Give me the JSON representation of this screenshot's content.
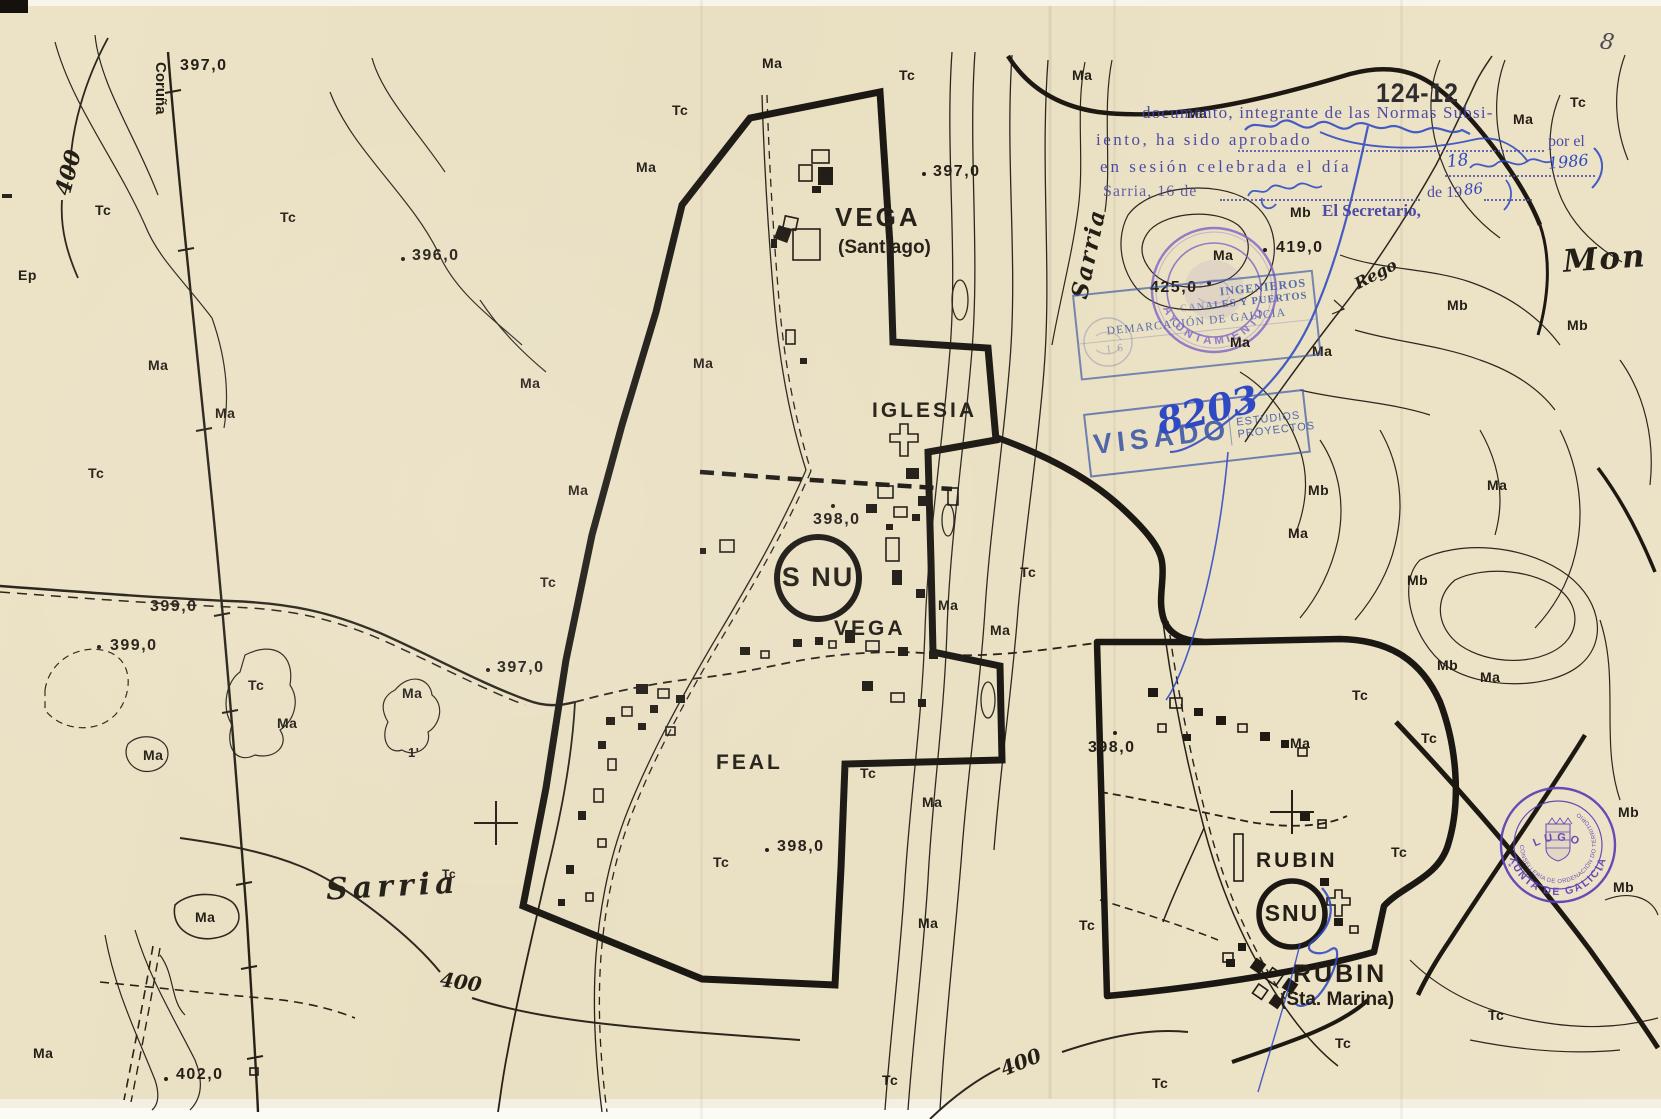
{
  "scan": {
    "page_number": "8",
    "sheet_code": "124-12"
  },
  "codes": {
    "ma": "Ma",
    "tc": "Tc",
    "mb": "Mb",
    "ep": "Ep",
    "tick": "1'"
  },
  "elevations": {
    "v396": "396,0",
    "v397": "397,0",
    "v398": "398,0",
    "v399": "399,0",
    "v400": "400",
    "v402": "402,0",
    "v419": "419,0",
    "v425": "425,0"
  },
  "places": {
    "coruna": "Coruña",
    "vega_main": "VEGA",
    "vega_main_sub": "(Santiago)",
    "iglesia": "IGLESIA",
    "vega_south": "VEGA",
    "feal": "FEAL",
    "snu_large": "S NU",
    "snu_small": "SNU",
    "sarria_town": "Sarria",
    "sarria_river": "Sarria",
    "rubin_north": "RUBIN",
    "rubin_south": "RUBIN",
    "rubin_south_sub": "(Sta. Marina)",
    "mon": "Mon",
    "rego": "Rego"
  },
  "approval_stamp": {
    "line1": "documento, integrante de las Normas Subsi-",
    "line2_pre": "iento, ha sido aprobado",
    "line2_post": "por el",
    "line3_pre": "en sesión celebrada el día",
    "line4_pre": "Sarria, 16 de",
    "line4_post": "de 19",
    "line5": "El Secretario,"
  },
  "handwriting": {
    "number": "8203",
    "day": "18",
    "year": "1986",
    "year_short": "86"
  },
  "visado_stamp": {
    "word": "VISADO",
    "cell_line1": "ESTUDIOS",
    "cell_line2": "PROYECTOS",
    "eng_line1": "INGENIEROS",
    "eng_line2": "CANALES Y PUERTOS",
    "eng_line3": "DEMARCACIÓN DE GALICIA",
    "eng_date": "16"
  },
  "ayuntamiento_stamp": {
    "text": "AYUNTAMIENTO"
  },
  "xunta_stamp": {
    "arc_top": "XUNTA DE GALICIA",
    "arc_inner": "CONSELLERÍA DE ORDENACIÓN DO TERRITORIO",
    "bottom": "LUGO",
    "note": "Ter. A Ob.",
    "star": "*"
  }
}
